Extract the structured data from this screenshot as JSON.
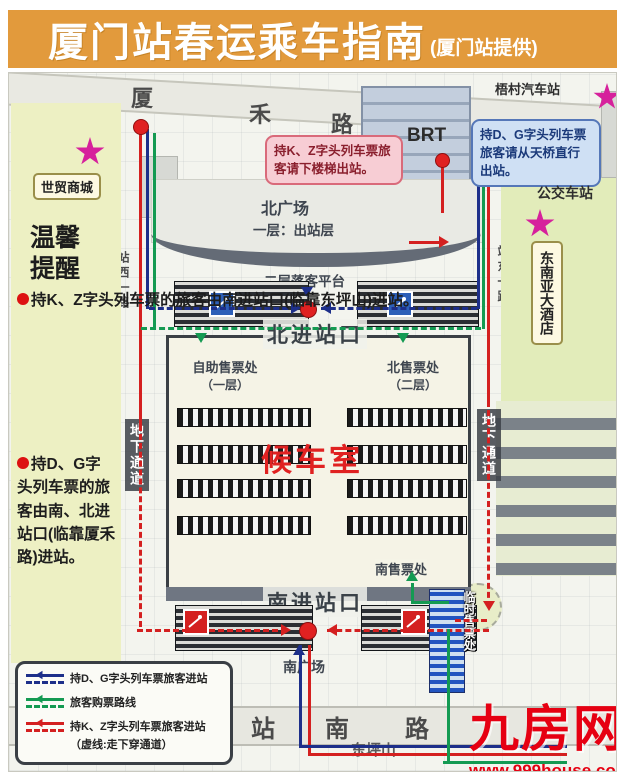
{
  "header": {
    "title": "厦门站春运乘车指南",
    "credit": "(厦门站提供)"
  },
  "roads": {
    "xiahe_chars": [
      "厦",
      "禾",
      "路"
    ],
    "zhannan_chars": [
      "站",
      "南",
      "路"
    ],
    "zhanxi": "站西一路",
    "zhandong": "站东一路",
    "underpass_left": "地下通道",
    "underpass_right": "地下通道",
    "dongpingshan": "东坪山"
  },
  "pois": {
    "shimao": "世贸商城",
    "wucun": "梧村汽车站",
    "bus": "公交车站",
    "hotel": "东南亚大酒店",
    "brt": "BRT",
    "brt_platform": "BRT站台"
  },
  "callouts": {
    "kz_exit": "持K、Z字头列车票旅客请下楼梯出站。",
    "dg_exit": "持D、G字头列车票旅客请从天桥直行出站。"
  },
  "notice": {
    "title": "温馨提醒",
    "item1": "持K、Z字头列车票的旅客由南进站口(临靠东坪山)进站。",
    "item2": "持D、G字头列车票的旅客由南、北进站口(临靠厦禾路)进站。"
  },
  "station": {
    "north_square": "北广场",
    "north_square_floor": "一层：出站层",
    "dropoff_platform": "二层落客平台",
    "north_gate": "北进站口",
    "self_ticket": "自助售票处",
    "self_ticket_floor": "（一层）",
    "north_ticket": "北售票处",
    "north_ticket_floor": "（二层）",
    "waiting_hall": "候车室",
    "south_ticket": "南售票处",
    "south_gate": "南进站口",
    "south_square": "南广场",
    "temp_ticket": "临时售票处"
  },
  "legend": {
    "items": [
      {
        "label": "持D、G字头列车票旅客进站",
        "color": "#1d2f8a"
      },
      {
        "label": "旅客购票路线",
        "color": "#149a52"
      },
      {
        "label": "持K、Z字头列车票旅客进站",
        "color": "#d42020"
      }
    ],
    "note": "（虚线:走下穿通道）"
  },
  "watermark": {
    "name": "九房网",
    "url": "www.999house.com"
  },
  "colors": {
    "header_bg": "#e29a3c",
    "route_red": "#d42020",
    "route_blue": "#1d2f8a",
    "route_green": "#149a52",
    "star": "#d6219c",
    "waiting_red": "#e02121"
  }
}
